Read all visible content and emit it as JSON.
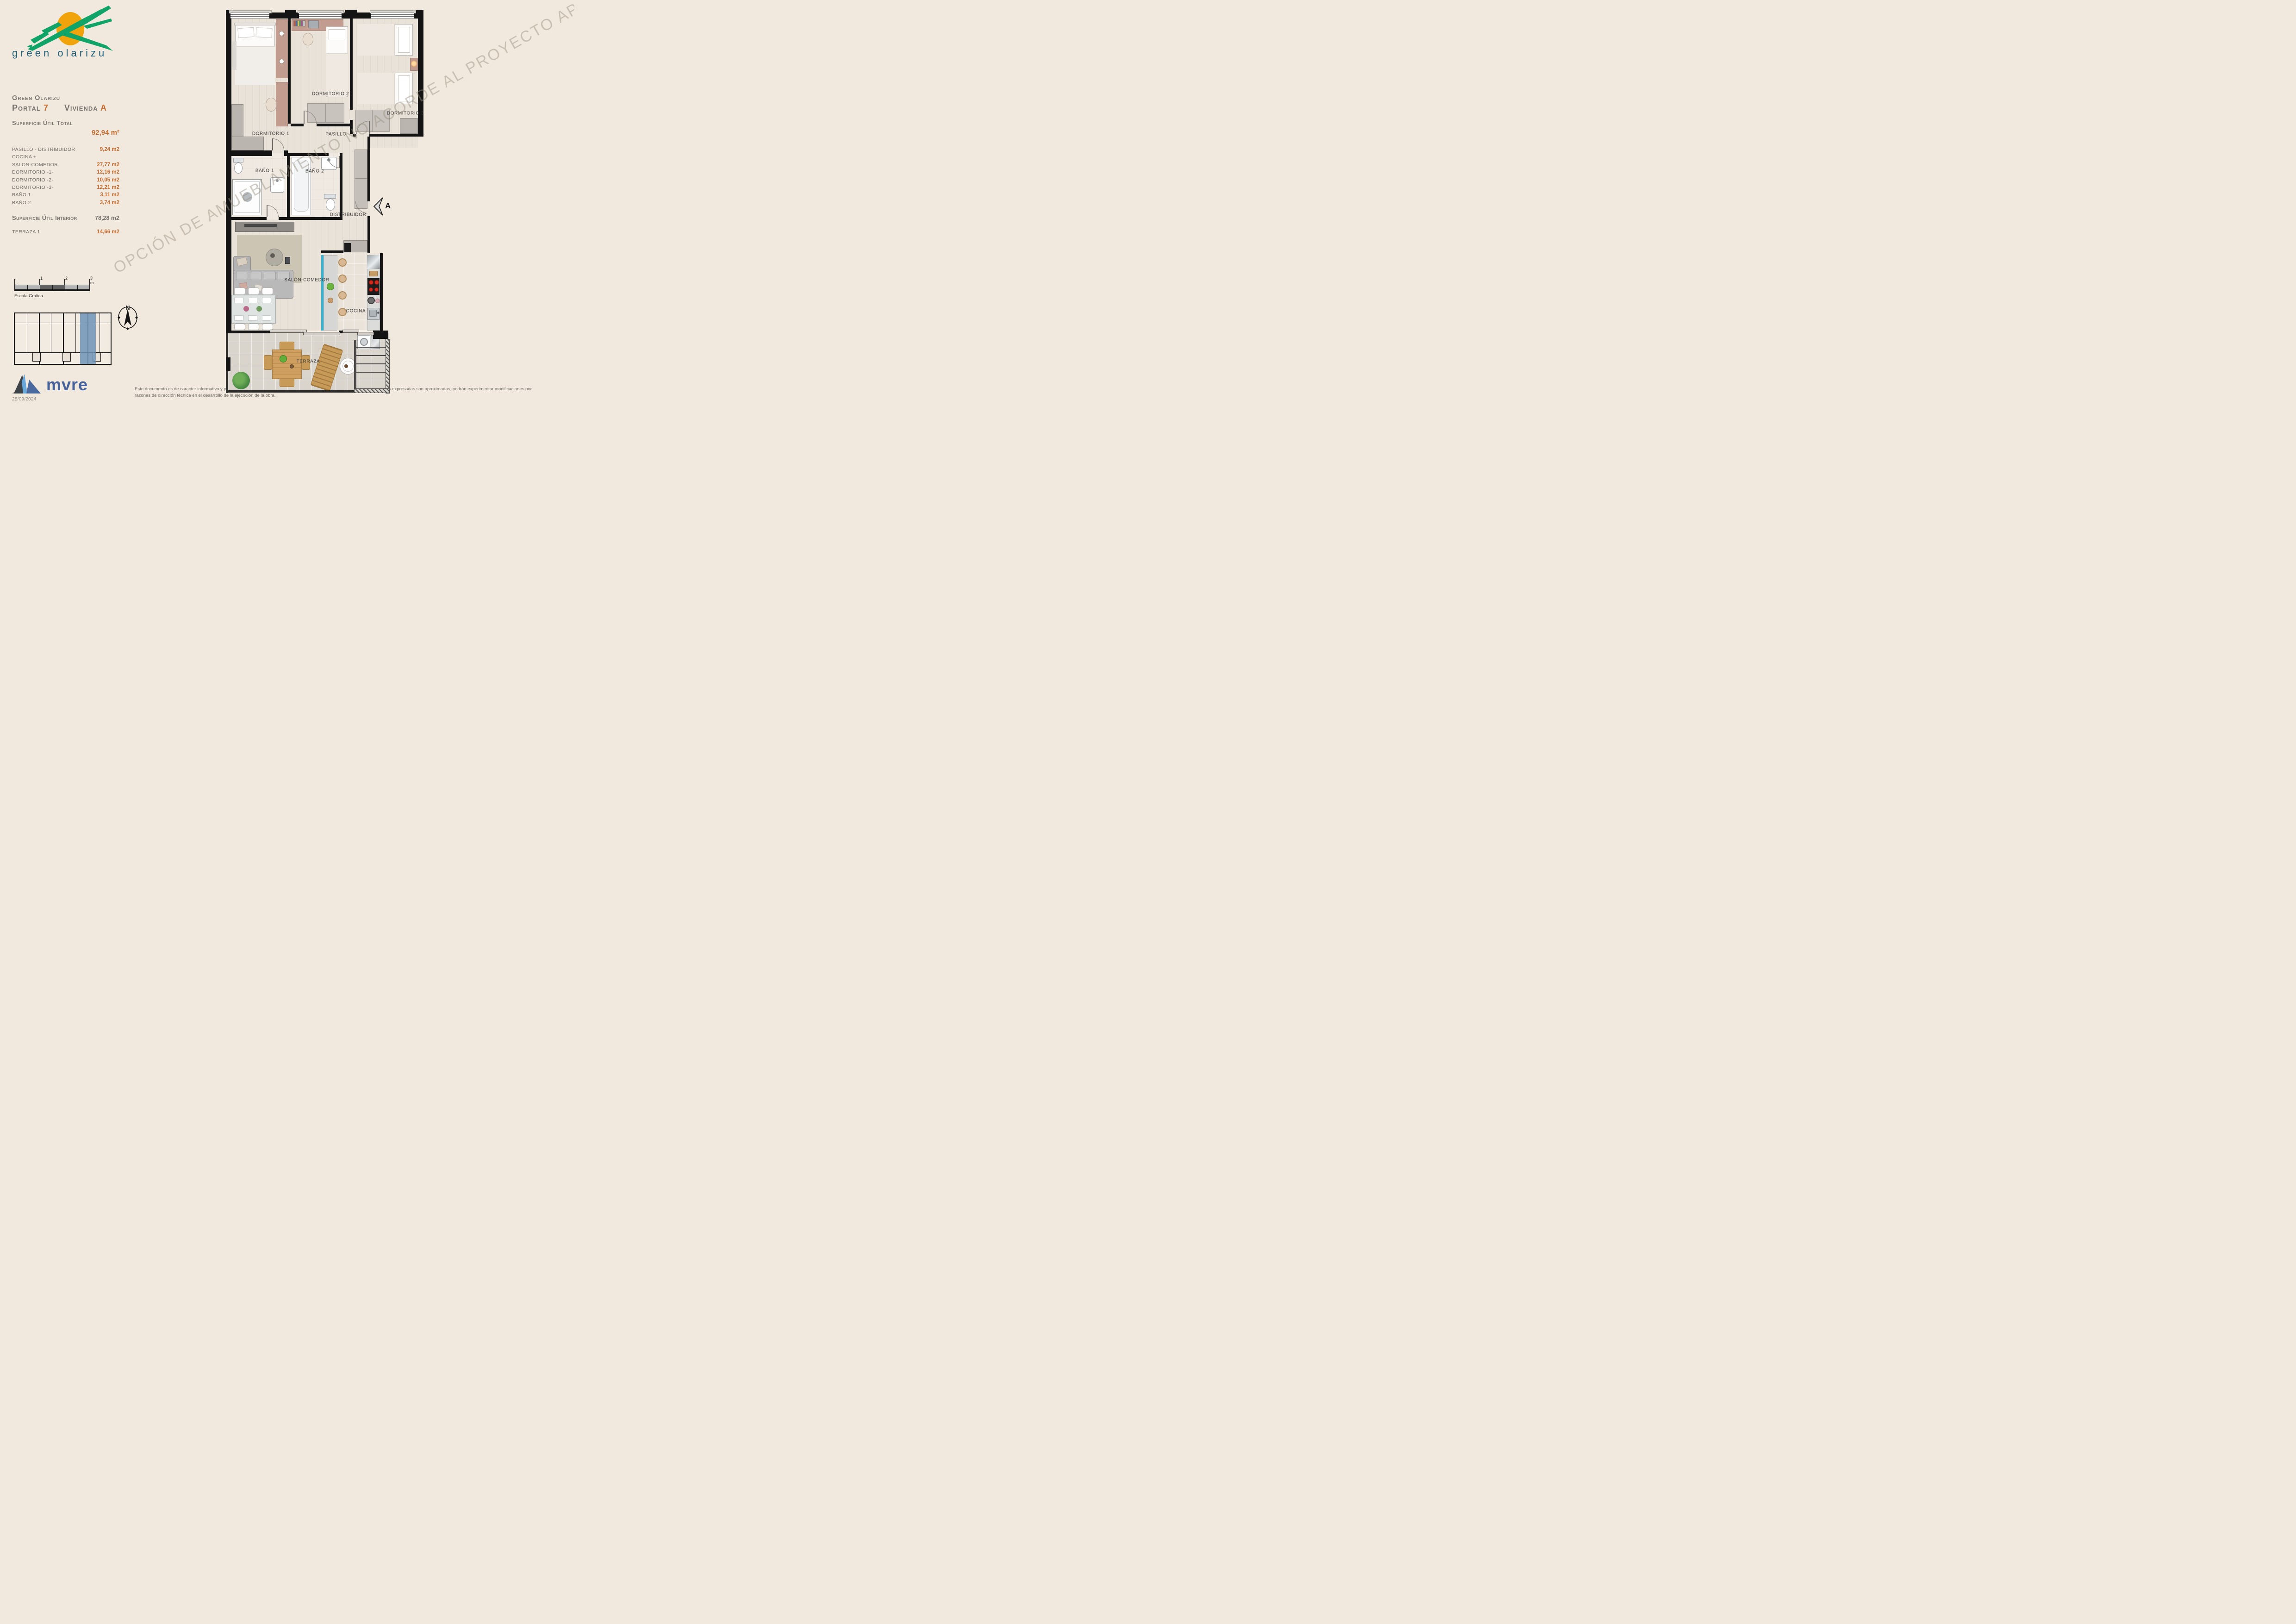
{
  "logo": {
    "brand": "green olarizu",
    "green": "#10a468",
    "sun": "#f0a30a",
    "text_color": "#20607a"
  },
  "sidebar": {
    "project": "Green Olarizu",
    "portal_label": "Portal",
    "portal_value": "7",
    "vivienda_label": "Vivienda",
    "vivienda_value": "A",
    "total_label": "Superficie Útil Total",
    "total_value": "92,94 m²",
    "rooms": [
      {
        "label": "PASILLO - DISTRIBUIDOR",
        "value": "9,24 m2"
      },
      {
        "label": "COCINA +",
        "value": ""
      },
      {
        "label": "SALON-COMEDOR",
        "value": "27,77 m2"
      },
      {
        "label": "DORMITORIO -1-",
        "value": "12,16 m2"
      },
      {
        "label": "DORMITORIO -2-",
        "value": "10,05 m2"
      },
      {
        "label": "DORMITORIO -3-",
        "value": "12,21 m2"
      },
      {
        "label": "BAÑO 1",
        "value": "3,11 m2"
      },
      {
        "label": "BAÑO 2",
        "value": "3,74 m2"
      }
    ],
    "interior_label": "Superficie Útil Interior",
    "interior_value": "78,28 m2",
    "terraza_label": "TERRAZA 1",
    "terraza_value": "14,66 m2",
    "scale": {
      "ticks": [
        "1",
        "2",
        "3 m."
      ],
      "caption": "Escala Gráfica"
    },
    "compass_north": "N"
  },
  "plan": {
    "watermark": "OPCIÓN DE AMUEBLAMIENTO NO ACORDE AL PROYECTO APROBADO",
    "section_marker": "A",
    "rooms": {
      "dormitorio1": "DORMITORIO 1",
      "dormitorio2": "DORMITORIO 2",
      "dormitorio3": "DORMITORIO 3",
      "pasillo": "PASILLO",
      "bano1": "BAÑO 1",
      "bano2": "BAÑO 2",
      "distribuidor": "DISTRIBUIDOR",
      "salon": "SALÓN-COMEDOR",
      "cocina": "COCINA",
      "terraza": "TERRAZA"
    }
  },
  "footer": {
    "brand": "mvre",
    "brand_color": "#47629b",
    "date": "25/09/2024",
    "disclaimer_line1": "Este documento es de caracter informativo y podrá experimentar variaciones por exigencias técnicas del proyecto. Las superficies expresadas son aproximadas, podrán experimentar modificaciones por",
    "disclaimer_line2": "razones de dirección técnica en el desarrollo de la ejecución de la obra."
  },
  "colors": {
    "background": "#f2e9de",
    "accent_orange": "#c76b2e",
    "text_gray": "#75716c",
    "wall_black": "#141414",
    "highlight_blue": "#6f94b7",
    "kitchen_counter_cyan": "#35b4d3"
  }
}
